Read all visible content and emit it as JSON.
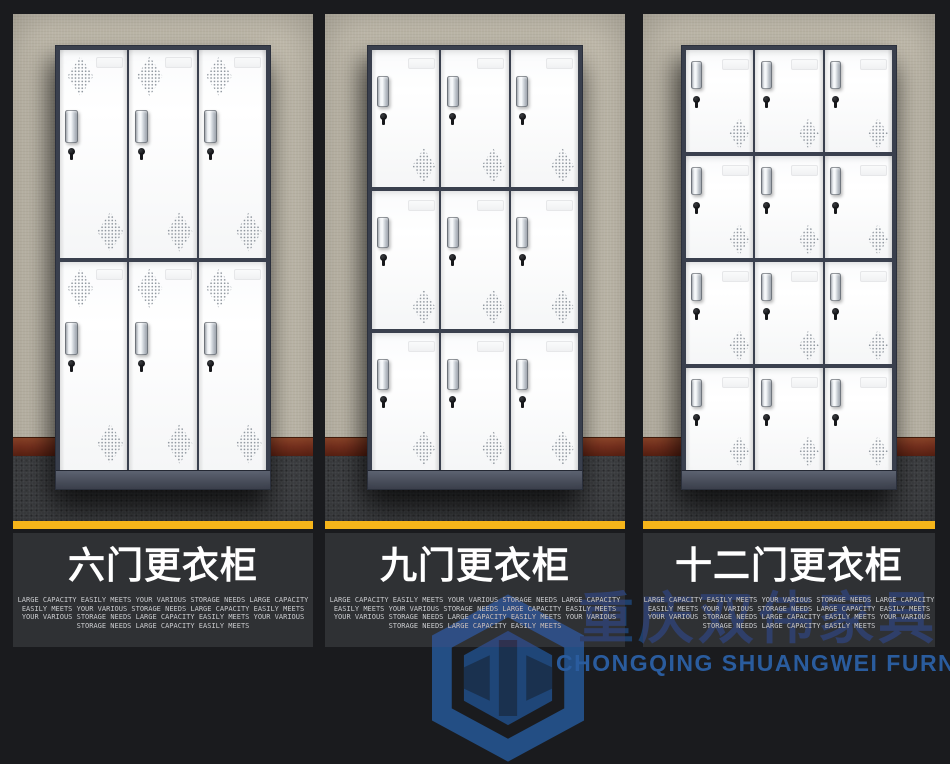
{
  "page": {
    "background": "#1a1b1e"
  },
  "colors": {
    "accent_yellow": "#f6b51a",
    "caption_background": "#2f3134",
    "title_text": "#ffffff",
    "description_text": "#c9cacd",
    "locker_frame": "#3a404e",
    "door_white": "#fcfdfd",
    "wall_beige": "#c6c0b1",
    "baseboard_brown": "#7c3320",
    "carpet_gray": "#3f4144",
    "watermark_dark_blue": "#1e3f6a",
    "watermark_blue": "#2a5c9e"
  },
  "panels": [
    {
      "title": "六门更衣柜",
      "locker": {
        "doors": 6,
        "rows": 2,
        "cols": 3,
        "top_vent": true
      },
      "desc": [
        "LARGE CAPACITY EASILY MEETS YOUR VARIOUS STORAGE NEEDS LARGE CAPACITY",
        "EASILY MEETS YOUR VARIOUS STORAGE NEEDS LARGE CAPACITY EASILY MEETS",
        "YOUR VARIOUS STORAGE NEEDS LARGE CAPACITY EASILY MEETS YOUR VARIOUS",
        "STORAGE NEEDS LARGE CAPACITY EASILY MEETS"
      ]
    },
    {
      "title": "九门更衣柜",
      "locker": {
        "doors": 9,
        "rows": 3,
        "cols": 3,
        "top_vent": false
      },
      "desc": [
        "LARGE CAPACITY EASILY MEETS YOUR VARIOUS STORAGE NEEDS LARGE CAPACITY",
        "EASILY MEETS YOUR VARIOUS STORAGE NEEDS LARGE CAPACITY EASILY MEETS",
        "YOUR VARIOUS STORAGE NEEDS LARGE CAPACITY EASILY MEETS YOUR VARIOUS",
        "STORAGE NEEDS LARGE CAPACITY EASILY MEETS"
      ]
    },
    {
      "title": "十二门更衣柜",
      "locker": {
        "doors": 12,
        "rows": 4,
        "cols": 3,
        "top_vent": false
      },
      "desc": [
        "LARGE CAPACITY EASILY MEETS YOUR VARIOUS STORAGE NEEDS LARGE CAPACITY",
        "EASILY MEETS YOUR VARIOUS STORAGE NEEDS LARGE CAPACITY EASILY MEETS",
        "YOUR VARIOUS STORAGE NEEDS LARGE CAPACITY EASILY MEETS YOUR VARIOUS",
        "STORAGE NEEDS LARGE CAPACITY EASILY MEETS"
      ]
    }
  ],
  "watermark": {
    "logo": "hexagon-cube-logo",
    "name_cn": "重庆双伟家具",
    "name_en": "CHONGQING SHUANGWEI FURNITURE"
  }
}
